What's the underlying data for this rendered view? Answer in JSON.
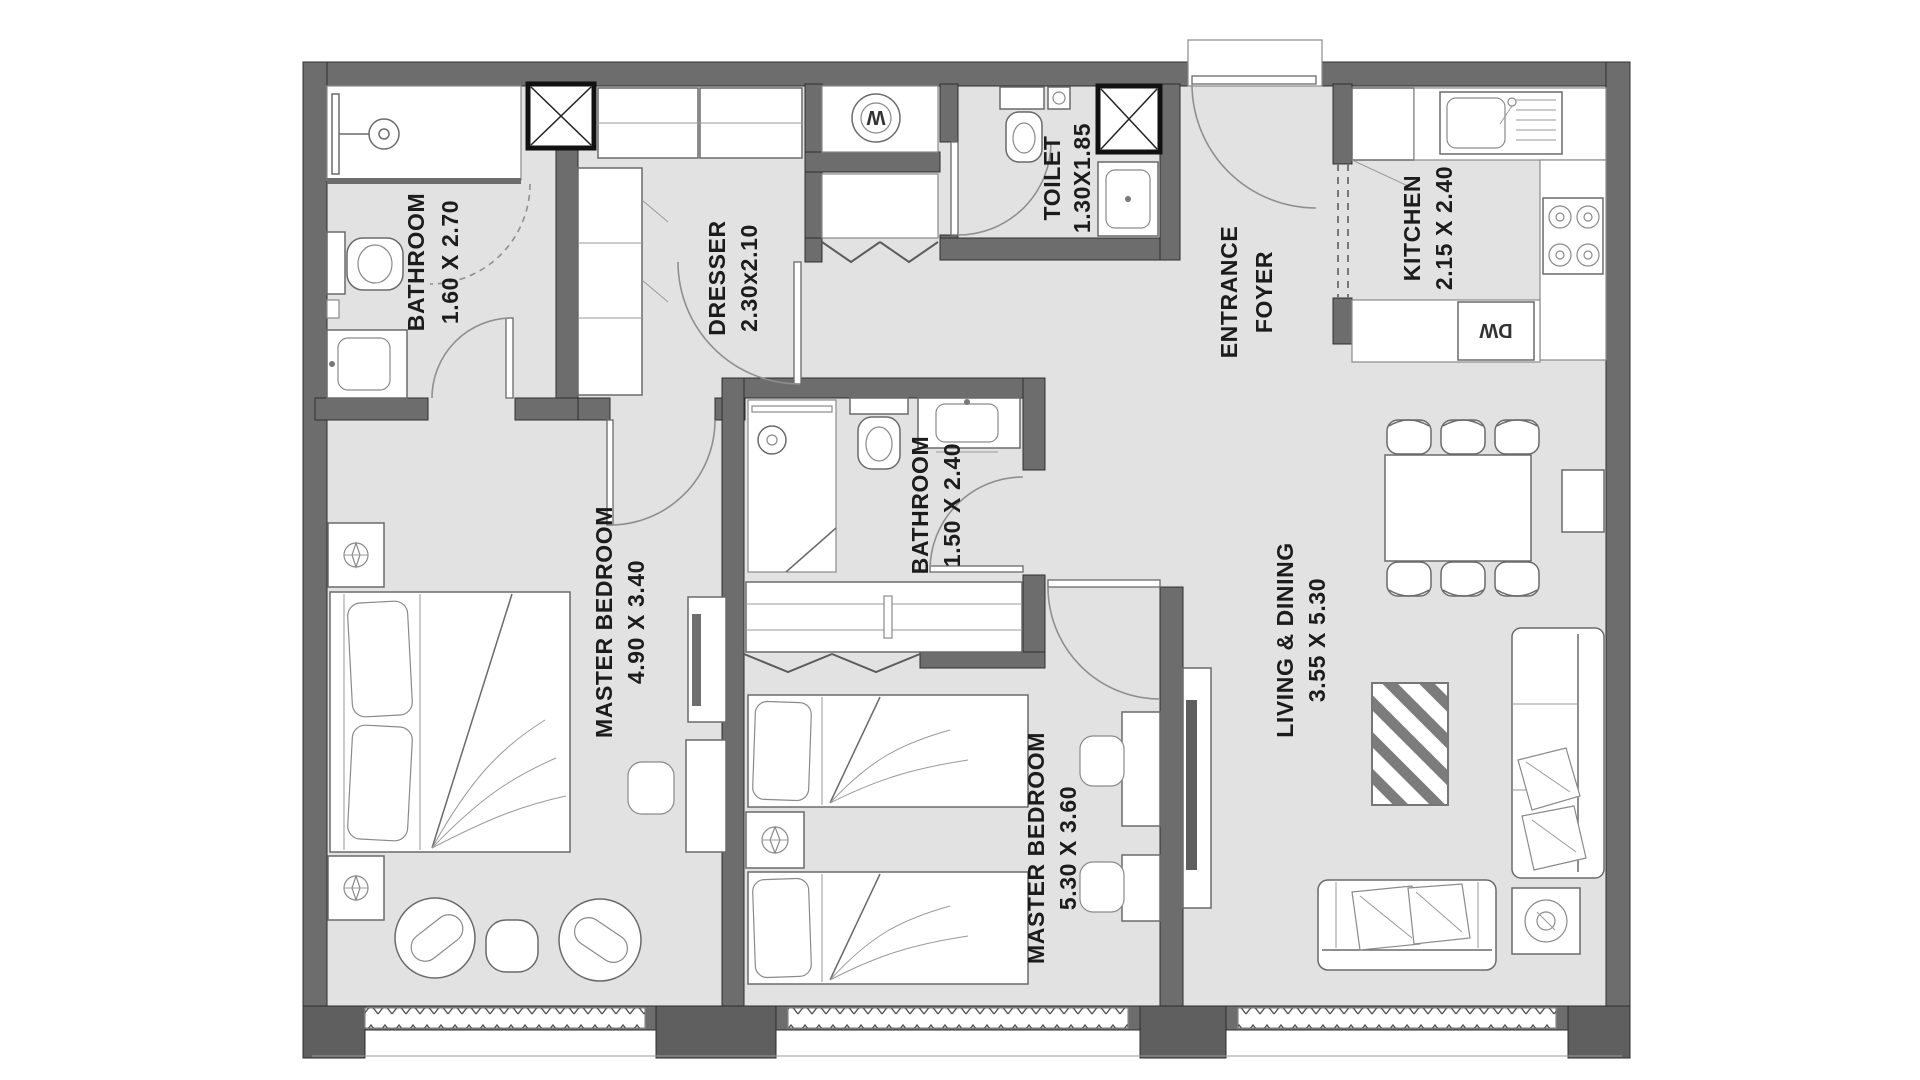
{
  "title": "Apartment floor plan",
  "colors": {
    "wall": "#6d6d6d",
    "floor": "#e2e2e2",
    "fixture_outline": "#6a6a6a",
    "text": "#1c1c1c",
    "background": "#ffffff"
  },
  "rooms": {
    "bathroom1": {
      "name": "BATHROOM",
      "dims": "1.60 X 2.70"
    },
    "dresser": {
      "name": "DRESSER",
      "dims": "2.30x2.10"
    },
    "toilet": {
      "name": "TOILET",
      "dims": "1.30X1.85"
    },
    "foyer": {
      "line1": "ENTRANCE",
      "line2": "FOYER"
    },
    "kitchen": {
      "name": "KITCHEN",
      "dims": "2.15 X 2.40"
    },
    "master_bedroom_1": {
      "name": "MASTER BEDROOM",
      "dims": "4.90 X 3.40"
    },
    "bathroom2": {
      "name": "BATHROOM",
      "dims": "1.50 X 2.40"
    },
    "master_bedroom_2": {
      "name": "MASTER BEDROOM",
      "dims": "5.30 X 3.60"
    },
    "living_dining": {
      "name": "LIVING & DINING",
      "dims": "3.55 X 5.30"
    }
  },
  "appliances": {
    "washer": "W",
    "dishwasher": "DW"
  }
}
